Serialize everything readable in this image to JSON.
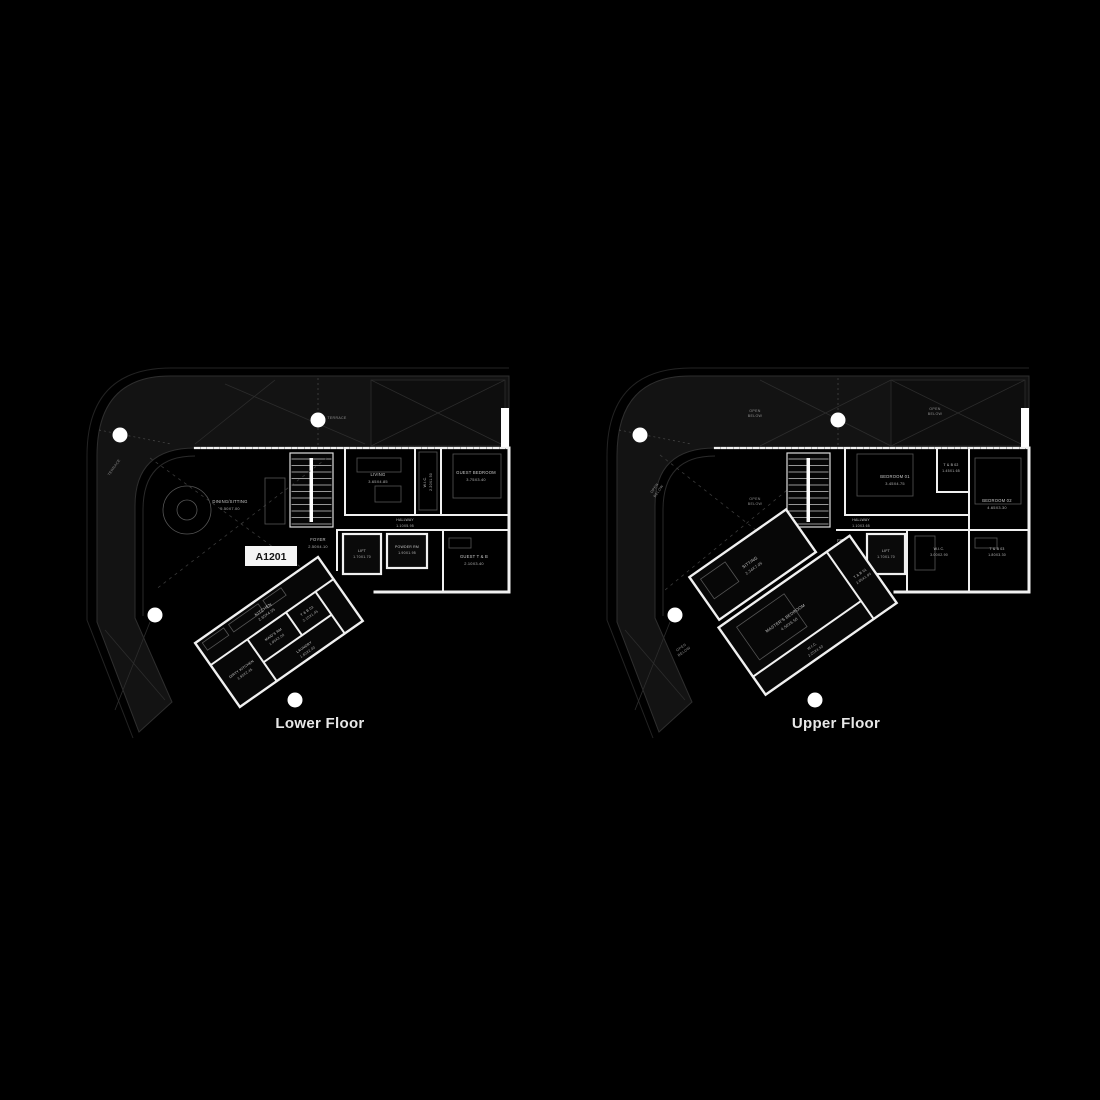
{
  "colors": {
    "background": "#000000",
    "site_band": "#131313",
    "wall": "#f0f0f0",
    "room_text": "#c9c9c9",
    "muted_text": "#8f8f8f",
    "title_text": "#e8e8e8",
    "entrance_marker": "#7c1416",
    "unit_tag_bg": "#f5f5f5",
    "unit_tag_text": "#141414"
  },
  "lower": {
    "title": "Lower Floor",
    "unit_label": "A1201",
    "terrace": "TERRACE",
    "rooms": {
      "dining": {
        "name": "DINING/SITTING",
        "dim": "5.50X7.00"
      },
      "living": {
        "name": "LIVING",
        "dim": "3.65X4.85"
      },
      "wic": {
        "name": "W.I.C.",
        "dim": "2.20X1.50"
      },
      "guest_bedroom": {
        "name": "GUEST BEDROOM",
        "dim": "3.75X3.40"
      },
      "hallway": {
        "name": "HALLWAY",
        "dim": "1.10X5.95"
      },
      "foyer": {
        "name": "FOYER",
        "dim": "2.50X4.10"
      },
      "lift": {
        "name": "LIFT",
        "dim": "1.70X1.70"
      },
      "powder": {
        "name": "POWDER RM",
        "dim": "1.90X1.95"
      },
      "guest_tb": {
        "name": "GUEST T & B",
        "dim": "2.10X3.40"
      },
      "kitchen": {
        "name": "KITCHEN",
        "dim": "2.65X4.55"
      },
      "dirty_kitchen": {
        "name": "DIRTY KITCHEN",
        "dim": "3.90X2.45"
      },
      "maids": {
        "name": "MAID'S RM",
        "dim": "1.95X2.00"
      },
      "tb03": {
        "name": "T & B 03",
        "dim": "2.10X1.45"
      },
      "laundry": {
        "name": "LAUNDRY",
        "dim": "1.60X2.00"
      }
    }
  },
  "upper": {
    "title": "Upper Floor",
    "open_below_l1": "OPEN",
    "open_below_l2": "BELOW",
    "rooms": {
      "bedroom1": {
        "name": "BEDROOM 01",
        "dim": "3.45X4.75"
      },
      "tb02": {
        "name": "T & B 02",
        "dim": "1.45X1.65"
      },
      "bedroom2": {
        "name": "BEDROOM 02",
        "dim": "4.65X3.30"
      },
      "hallway": {
        "name": "HALLWAY",
        "dim": "1.10X3.65"
      },
      "foyer": {
        "name": "FOYER",
        "dim": "2.50X4.10"
      },
      "lift": {
        "name": "LIFT",
        "dim": "1.70X1.70"
      },
      "wic": {
        "name": "W.I.C.",
        "dim": "3.00X2.90"
      },
      "tb03": {
        "name": "T & B 03",
        "dim": "1.80X3.30"
      },
      "sitting": {
        "name": "SITTING",
        "dim": "2.34X7.05"
      },
      "master": {
        "name": "MASTER'S BEDROOM",
        "dim": "4.50X6.50"
      },
      "master_wic": {
        "name": "W.I.C.",
        "dim": "2.20X4.50"
      },
      "tb01": {
        "name": "T & B 01",
        "dim": "2.65X1.95"
      }
    }
  }
}
